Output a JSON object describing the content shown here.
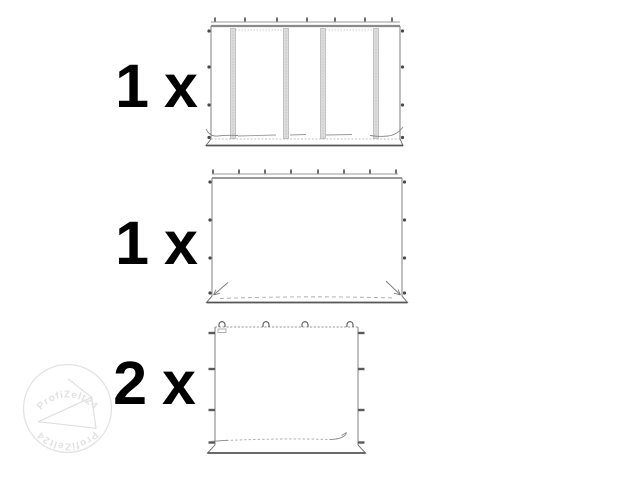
{
  "items": [
    {
      "quantity": "1 x",
      "part": "sidewall-panel-with-two-windows"
    },
    {
      "quantity": "1 x",
      "part": "plain-sidewall-panel"
    },
    {
      "quantity": "2 x",
      "part": "plain-end-wall-panel"
    }
  ],
  "watermark": {
    "brand_top": "ProfiZelt24",
    "brand_bottom": "ProfiZelt24",
    "logo_icon": "tent-triangle-icon",
    "color": "#e2e2e2"
  },
  "colors": {
    "background": "#ffffff",
    "label_text": "#000000",
    "drawing_line": "#7a7a7a",
    "window_strip_fill": "#dcdcdc",
    "attachment_marks": "#4a4a4a"
  }
}
